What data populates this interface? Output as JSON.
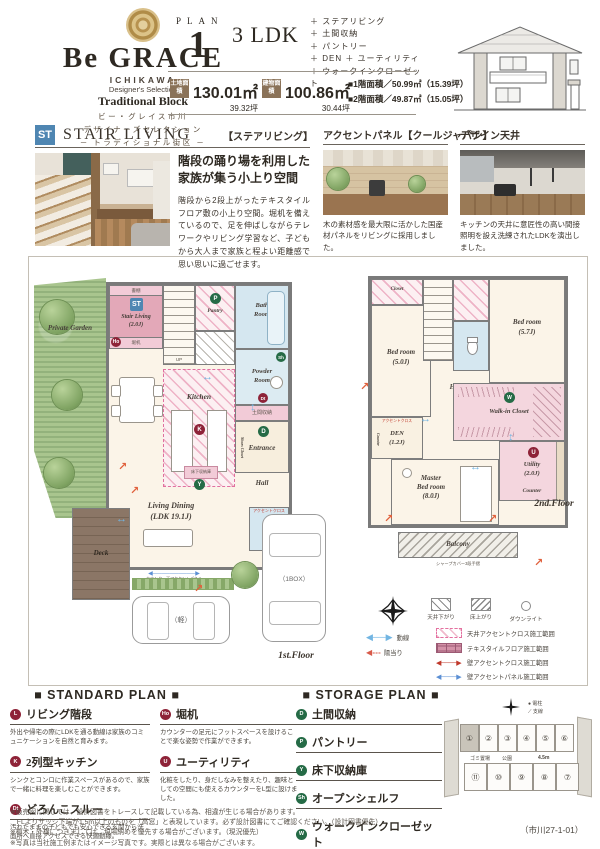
{
  "header": {
    "brand": "Be GRACE",
    "brand_sub1": "ICHIKAWA",
    "brand_sub2": "Designer's Selection",
    "brand_sub3": "Traditional Block",
    "brand_jp1": "ビー・グレイス市川",
    "brand_jp2": "デザイナーズセレクション",
    "brand_jp3": "─ トラディショナル街区 ─",
    "plan_label": "PLAN",
    "plan_number": "1",
    "plan_type": "3 LDK",
    "features": [
      "＋ ステアリビング",
      "＋ 土間収納",
      "＋ パントリー",
      "＋ DEN ＋ ユーティリティ",
      "＋ ウォークインクローゼット"
    ],
    "land_label": "土地面積",
    "land_m2": "130.01㎡",
    "land_tsubo": "39.32坪",
    "bldg_label": "建物面積",
    "bldg_m2": "100.86㎡",
    "bldg_tsubo": "30.44坪",
    "floor1_area": "■1階面積／50.99㎡（15.39坪）",
    "floor2_area": "■2階面積／49.87㎡（15.05坪）"
  },
  "stair_living": {
    "badge": "ST",
    "title_en": "STAIR LIVING",
    "title_jp": "【ステアリビング】",
    "headline1": "階段の踊り場を利用した",
    "headline2": "家族が集う小上り空間",
    "body": "階段から2段上がったテキスタイルフロア敷の小上り空間。堀机を備えているので、足を伸ばしながらテレワークやリビング学習など、子どもから大人まで家族と程よい距離感で思い思いに過ごせます。"
  },
  "accent_panel": {
    "title": "アクセントパネル【クールジャパン】",
    "caption": "木の素材感を最大限に活かした国産材パネルをリビングに採用しました。"
  },
  "design_ceiling": {
    "title": "デザイン天井",
    "caption": "キッチンの天井に意匠性の高い間接照明を設え洗練されたLDKを演出しました。"
  },
  "badges": {
    "st": "ST",
    "l": "L",
    "ho": "Ho",
    "p": "P",
    "k": "K",
    "y": "Y",
    "sh": "Sh",
    "dt": "Dt",
    "d": "D",
    "w": "W",
    "u": "U"
  },
  "plan1": {
    "floor_label": "1st.Floor",
    "garden": "Private Garden",
    "deck": "Deck",
    "shelf": "書棚",
    "stair_name": "Stair Living",
    "stair_size": "(2.0J)",
    "desk": "堀机",
    "up": "UP",
    "pantry": "Pantry",
    "bath1": "Bath",
    "bath2": "Room",
    "powder1": "Powder",
    "powder2": "Room",
    "doma": "土間収納",
    "entrance": "Entrance",
    "shoes": "Shoes Closet",
    "hall": "Hall",
    "kitchen": "Kitchen",
    "underfloor": "床下収納庫",
    "living1": "Living Dining",
    "living2": "(LDK 19.1J)",
    "counter_note": "カウンター下アクセントパネル",
    "accent_cloth": "アクセントクロス",
    "car_small": "（軽）",
    "car_box": "（1BOX）"
  },
  "plan2": {
    "floor_label": "2nd.Floor",
    "closet": "Closet",
    "bed1_name": "Bed room",
    "bed1_size": "(5.0J)",
    "bed2_name": "Bed room",
    "bed2_size": "(5.7J)",
    "hall": "Hall",
    "den_name": "DEN",
    "den_size": "(1.2J)",
    "den_accent": "アクセントクロス",
    "counter_side": "Counter",
    "wic": "Walk-in Closet",
    "utility_name": "Utility",
    "utility_size": "(2.0J)",
    "counter": "Counter",
    "master1": "Master",
    "master2": "Bed room",
    "master3": "(8.0J)",
    "balcony": "Balcony",
    "handrail": "シャープカバー3段手摺"
  },
  "legend": {
    "ceiling_drop": "天井下がり",
    "floor_up": "床上がり",
    "downlight": "ダウンライト",
    "flow": "動線",
    "sunlight": "陽当り",
    "ranges": [
      {
        "type": "hatch-pink",
        "label": "天井アクセントクロス施工範囲"
      },
      {
        "type": "grid-pink",
        "label": "テキスタイルフロア施工範囲"
      },
      {
        "type": "line-red",
        "label": "壁アクセントクロス施工範囲"
      },
      {
        "type": "line-blue",
        "label": "壁アクセントパネル施工範囲"
      }
    ]
  },
  "standard_plan": {
    "title": "■ STANDARD PLAN ■",
    "col1": [
      {
        "letter": "L",
        "color": "red",
        "title": "リビング階段",
        "desc": "外出や帰宅の際にLDKを通る動線は家族のコミュニケーションを自然と育みます。"
      },
      {
        "letter": "K",
        "color": "red",
        "title": "2列型キッチン",
        "desc": "シンクとコンロに作業スペースがあるので、家族で一緒に料理を楽しむことができます。"
      },
      {
        "letter": "Dt",
        "color": "red",
        "title": "どろんこスルー",
        "desc": "汚れたままの子どもでも安心できる玄関から洗面所へ直接アクセスできる快適動線。"
      }
    ],
    "col2": [
      {
        "letter": "Ho",
        "color": "red",
        "title": "堀机",
        "desc": "カウンターの足元にフットスペースを設けることで楽な姿勢で作業ができます。"
      },
      {
        "letter": "U",
        "color": "red",
        "title": "ユーティリティ",
        "desc": "化粧をしたり、身だしなみを整えたり、趣味としての空間にも使えるカウンターをL型に設けました。"
      }
    ]
  },
  "storage_plan": {
    "title": "■ STORAGE PLAN ■",
    "items": [
      {
        "letter": "D",
        "color": "green",
        "title": "土間収納"
      },
      {
        "letter": "P",
        "color": "green",
        "title": "パントリー"
      },
      {
        "letter": "Y",
        "color": "green",
        "title": "床下収納庫"
      },
      {
        "letter": "Sh",
        "color": "green",
        "title": "オープンシェルフ"
      },
      {
        "letter": "W",
        "color": "green",
        "title": "ウォークインクローゼット"
      }
    ]
  },
  "sitemap": {
    "lots_top": [
      "①",
      "②",
      "③",
      "④",
      "⑤",
      "⑥"
    ],
    "lots_bottom": [
      "⑪",
      "⑩",
      "⑨",
      "⑧",
      "⑦"
    ],
    "road": "4.5m",
    "trash": "ゴミ置場",
    "park": "公園",
    "pole": "● 電柱",
    "wire": "⟋ 支線"
  },
  "footer": {
    "notes": [
      "※販売図に関しては、設計図書をトレースして記載している為、相違が生じる場合があります。",
      "　FLよりサッシ下端が1.5m以上のものを「高窓」と表現しています。必ず設計図書にてご確認ください。（設計図書優先）",
      "※植木・外構につきましては、現場納めを優先する場合がございます。（現況優先）",
      "※写真は当社施工例またはイメージ写真です。実際とは異なる場合がございます。"
    ],
    "code": "（市川27-1-01）"
  },
  "colors": {
    "accent_blue": "#4f86b2",
    "badge_red": "#8e2338",
    "badge_green": "#256b46",
    "room_pink": "#e3a8b8",
    "room_blue": "#d5e7f0"
  }
}
